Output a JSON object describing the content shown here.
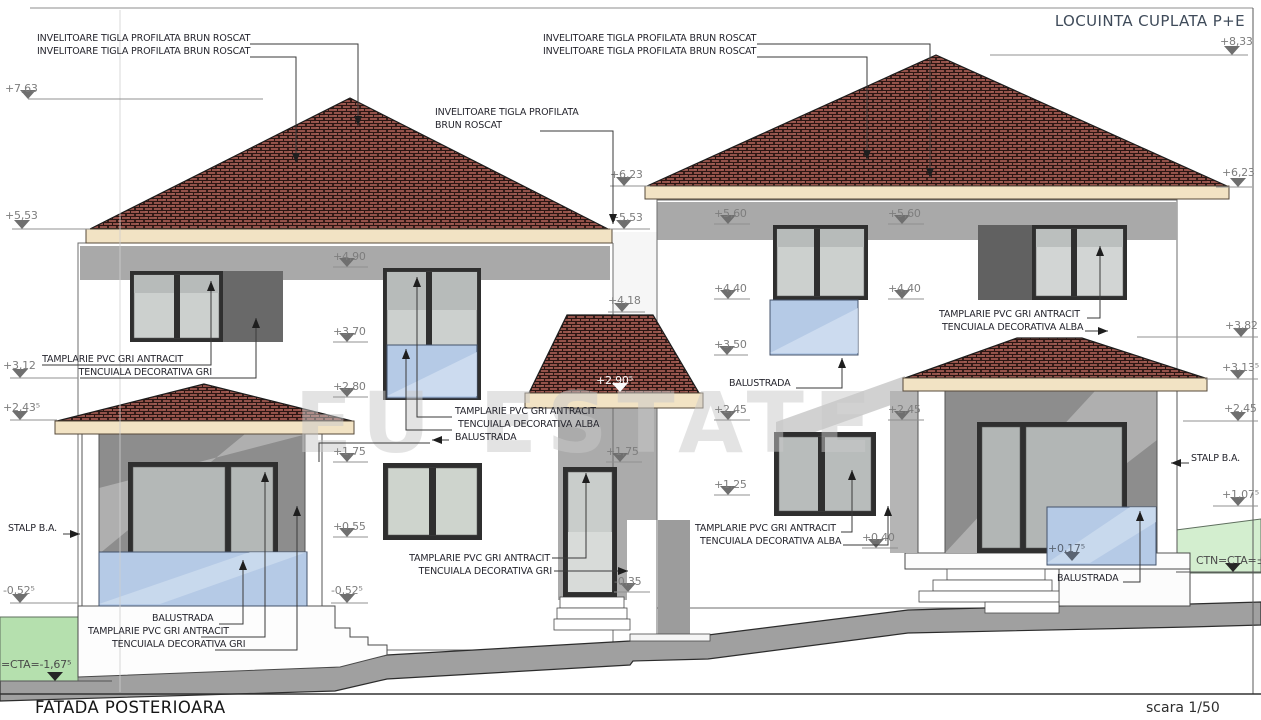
{
  "title": "LOCUINTA CUPLATA P+E",
  "footer": {
    "name": "FATADA POSTERIOARA",
    "scale": "scara 1/50"
  },
  "watermark": "EU ESTATE",
  "colors": {
    "roof_tile": "#94524a",
    "eave_band": "#f2e3c4",
    "balustrade_blue": "#b5cae6",
    "grass_left": "#b5e0ae",
    "grass_right": "#d3eecf",
    "terrain": "#a0a0a0",
    "porch_shadow": "#8d8d8d",
    "level_mark": "#7d7d7d"
  },
  "levels": [
    {
      "t": "+7,63",
      "x": 5,
      "y": 92,
      "tri": 28,
      "ly": 99,
      "l": [
        28,
        263
      ]
    },
    {
      "t": "+5,53",
      "x": 5,
      "y": 219,
      "tri": 22,
      "ly": 229,
      "l": [
        12,
        90
      ]
    },
    {
      "t": "+3,12",
      "x": 3,
      "y": 369,
      "tri": 20,
      "ly": 378,
      "l": [
        10,
        78
      ]
    },
    {
      "t": "+2,43⁵",
      "x": 3,
      "y": 411,
      "tri": 20,
      "ly": 420,
      "l": [
        10,
        57
      ]
    },
    {
      "t": "-0,52⁵",
      "x": 3,
      "y": 594,
      "tri": 20,
      "ly": 603,
      "l": [
        10,
        78
      ]
    },
    {
      "t": "=CTA=-1,67⁵",
      "x": 1,
      "y": 668,
      "tri": 55,
      "ly": 681,
      "l": [
        0,
        112
      ],
      "s": "dark"
    },
    {
      "t": "+4,90",
      "x": 333,
      "y": 260,
      "tri": 347,
      "ly": 267,
      "l": [
        333,
        368
      ]
    },
    {
      "t": "+3,70",
      "x": 333,
      "y": 335,
      "tri": 347,
      "ly": 342,
      "l": [
        333,
        368
      ]
    },
    {
      "t": "+2,80",
      "x": 333,
      "y": 390,
      "tri": 347,
      "ly": 397,
      "l": [
        333,
        368
      ]
    },
    {
      "t": "+1,75",
      "x": 333,
      "y": 455,
      "tri": 347,
      "ly": 462,
      "l": [
        333,
        368
      ]
    },
    {
      "t": "+0,55",
      "x": 333,
      "y": 530,
      "tri": 347,
      "ly": 537,
      "l": [
        333,
        368
      ]
    },
    {
      "t": "-0,52⁵",
      "x": 331,
      "y": 594,
      "tri": 347,
      "ly": 603,
      "l": [
        331,
        368
      ]
    },
    {
      "t": "+6,23",
      "x": 610,
      "y": 178,
      "tri": 624,
      "ly": 186,
      "l": [
        610,
        650
      ]
    },
    {
      "t": "+5,53",
      "x": 610,
      "y": 221,
      "tri": 624,
      "ly": 229,
      "l": [
        610,
        650
      ]
    },
    {
      "t": "+4,18",
      "x": 608,
      "y": 304,
      "tri": 622,
      "ly": 312,
      "l": [
        608,
        645
      ]
    },
    {
      "t": "+2,90⁵",
      "x": 596,
      "y": 384,
      "tri": 620,
      "ly": 392,
      "s": "white"
    },
    {
      "t": "+1,75",
      "x": 606,
      "y": 455,
      "tri": 620,
      "ly": 462,
      "l": [
        606,
        642
      ]
    },
    {
      "t": "-0,35",
      "x": 614,
      "y": 585,
      "tri": 628,
      "ly": 592,
      "l": [
        614,
        650
      ]
    },
    {
      "t": "+5,60",
      "x": 714,
      "y": 217,
      "tri": 728,
      "ly": 224,
      "l": [
        714,
        750
      ]
    },
    {
      "t": "+4,40",
      "x": 714,
      "y": 292,
      "tri": 728,
      "ly": 299,
      "l": [
        714,
        750
      ]
    },
    {
      "t": "+3,50",
      "x": 714,
      "y": 348,
      "tri": 727,
      "ly": 355,
      "l": [
        714,
        748
      ]
    },
    {
      "t": "+2,45",
      "x": 714,
      "y": 413,
      "tri": 728,
      "ly": 420,
      "l": [
        714,
        750
      ]
    },
    {
      "t": "+1,25",
      "x": 714,
      "y": 488,
      "tri": 728,
      "ly": 495,
      "l": [
        714,
        750
      ]
    },
    {
      "t": "+0,40",
      "x": 862,
      "y": 541,
      "tri": 876,
      "ly": 548,
      "l": [
        862,
        898
      ]
    },
    {
      "t": "+5,60",
      "x": 888,
      "y": 217,
      "tri": 902,
      "ly": 224,
      "l": [
        888,
        924
      ]
    },
    {
      "t": "+4,40",
      "x": 888,
      "y": 292,
      "tri": 902,
      "ly": 299,
      "l": [
        888,
        924
      ]
    },
    {
      "t": "+2,45",
      "x": 888,
      "y": 413,
      "tri": 902,
      "ly": 420,
      "l": [
        888,
        924
      ]
    },
    {
      "t": "+8,33",
      "x": 1220,
      "y": 45,
      "tri": 1232,
      "ly": 55,
      "l": [
        990,
        1248
      ]
    },
    {
      "t": "+6,23",
      "x": 1222,
      "y": 176,
      "tri": 1238,
      "ly": 187,
      "l": [
        1216,
        1252
      ]
    },
    {
      "t": "+3,82",
      "x": 1225,
      "y": 329,
      "tri": 1241,
      "ly": 337,
      "l": [
        1137,
        1258
      ]
    },
    {
      "t": "+3,13⁵",
      "x": 1222,
      "y": 371,
      "tri": 1238,
      "ly": 379,
      "l": [
        1205,
        1258
      ]
    },
    {
      "t": "+2,45",
      "x": 1224,
      "y": 412,
      "tri": 1238,
      "ly": 421,
      "l": [
        1183,
        1258
      ]
    },
    {
      "t": "+1,07⁵",
      "x": 1222,
      "y": 498,
      "tri": 1238,
      "ly": 506,
      "l": [
        1213,
        1258
      ]
    },
    {
      "t": "CTN=CTA=±",
      "x": 1196,
      "y": 564,
      "tri": 1233,
      "ly": 572,
      "l": [
        1176,
        1261
      ],
      "s": "dark"
    },
    {
      "t": "+0,17⁵",
      "x": 1048,
      "y": 552,
      "tri": 1072,
      "ly": 561,
      "s": "onblue"
    }
  ],
  "annotations": [
    {
      "n": "roof-label-top-left",
      "lines": [
        {
          "t": "INVELITOARE TIGLA PROFILATA BRUN ROSCAT",
          "x": 37,
          "y": 41
        },
        {
          "t": "INVELITOARE TIGLA PROFILATA BRUN ROSCAT",
          "x": 37,
          "y": 54
        }
      ],
      "leaders": [
        {
          "p": "250,44 358,44 358,126",
          "a": "down"
        },
        {
          "p": "250,57 296,57 296,163",
          "a": "down"
        }
      ]
    },
    {
      "n": "roof-label-top-mid",
      "lines": [
        {
          "t": "INVELITOARE TIGLA PROFILATA BRUN ROSCAT",
          "x": 543,
          "y": 41
        },
        {
          "t": "INVELITOARE TIGLA PROFILATA BRUN ROSCAT",
          "x": 543,
          "y": 54
        }
      ],
      "leaders": [
        {
          "p": "757,44 930,44 930,178",
          "a": "down"
        },
        {
          "p": "757,57 867,57 867,160",
          "a": "down"
        }
      ]
    },
    {
      "n": "roof-label-mid-left",
      "lines": [
        {
          "t": "INVELITOARE TIGLA PROFILATA",
          "x": 435,
          "y": 115
        },
        {
          "t": "BRUN ROSCAT",
          "x": 435,
          "y": 128
        }
      ],
      "leaders": [
        {
          "p": "540,131 613,131 613,224",
          "a": "down"
        }
      ]
    },
    {
      "n": "tamplarie-gri-upper-left",
      "lines": [
        {
          "t": "TAMPLARIE PVC GRI ANTRACIT",
          "x": 183,
          "y": 362,
          "a": "end"
        },
        {
          "t": "TENCUIALA DECORATIVA GRI",
          "x": 212,
          "y": 375,
          "a": "end"
        }
      ],
      "leaders": [
        {
          "p": "42,365 211,365 211,281",
          "a": "up"
        },
        {
          "p": "80,378 256,378 256,318",
          "a": "up"
        }
      ]
    },
    {
      "n": "tamplarie-alba-mid",
      "lines": [
        {
          "t": "TAMPLARIE PVC GRI ANTRACIT",
          "x": 455,
          "y": 414
        },
        {
          "t": "TENCUIALA DECORATIVA ALBA",
          "x": 458,
          "y": 427
        },
        {
          "t": "BALUSTRADA",
          "x": 455,
          "y": 440
        }
      ],
      "leaders": [
        {
          "p": "452,417 417,417 417,277",
          "a": "up"
        },
        {
          "p": "452,430 406,430 406,349",
          "a": "up"
        },
        {
          "p": "449,440 432,440",
          "a": "left"
        },
        {
          "p": "430,443 319,443 319,462",
          "a": "none"
        }
      ]
    },
    {
      "n": "stalp-ba-left",
      "lines": [
        {
          "t": "STALP B.A.",
          "x": 8,
          "y": 531
        }
      ],
      "leaders": [
        {
          "p": "63,534 80,534",
          "a": "right"
        }
      ]
    },
    {
      "n": "balustrada-bottom-left",
      "lines": [
        {
          "t": "BALUSTRADA",
          "x": 152,
          "y": 621
        }
      ],
      "leaders": [
        {
          "p": "219,624 243,624 243,560",
          "a": "up"
        }
      ]
    },
    {
      "n": "tamplarie-bottom-left",
      "lines": [
        {
          "t": "TAMPLARIE PVC GRI ANTRACIT",
          "x": 88,
          "y": 634
        }
      ],
      "leaders": [
        {
          "p": "201,637 265,637 265,472",
          "a": "up"
        }
      ]
    },
    {
      "n": "tencuiala-bottom-left",
      "lines": [
        {
          "t": "TENCUIALA DECORATIVA GRI",
          "x": 112,
          "y": 647
        }
      ],
      "leaders": [
        {
          "p": "215,650 297,650 297,506",
          "a": "up"
        }
      ]
    },
    {
      "n": "tamplarie-door-mid",
      "lines": [
        {
          "t": "TAMPLARIE PVC GRI ANTRACIT",
          "x": 550,
          "y": 561,
          "a": "end"
        },
        {
          "t": "TENCUIALA DECORATIVA GRI",
          "x": 552,
          "y": 574,
          "a": "end"
        }
      ],
      "leaders": [
        {
          "p": "552,558 586,558 586,473",
          "a": "up"
        },
        {
          "p": "554,571 628,571",
          "a": "right"
        }
      ]
    },
    {
      "n": "tamplarie-alba-right-upper",
      "lines": [
        {
          "t": "TAMPLARIE PVC GRI ANTRACIT",
          "x": 939,
          "y": 317
        },
        {
          "t": "TENCUIALA DECORATIVA ALBA",
          "x": 942,
          "y": 330
        }
      ],
      "leaders": [
        {
          "p": "1087,318 1100,318 1100,246",
          "a": "up"
        },
        {
          "p": "1085,331 1108,331",
          "a": "right"
        }
      ]
    },
    {
      "n": "balustrada-right-mid",
      "lines": [
        {
          "t": "BALUSTRADA",
          "x": 729,
          "y": 386
        }
      ],
      "leaders": [
        {
          "p": "796,388 842,388 842,358",
          "a": "up"
        }
      ]
    },
    {
      "n": "stalp-ba-right",
      "lines": [
        {
          "t": "STALP B.A.",
          "x": 1191,
          "y": 461
        }
      ],
      "leaders": [
        {
          "p": "1189,463 1171,463",
          "a": "left"
        }
      ]
    },
    {
      "n": "tamplarie-alba-bottom-right",
      "lines": [
        {
          "t": "TAMPLARIE PVC GRI ANTRACIT",
          "x": 695,
          "y": 531
        },
        {
          "t": "TENCUIALA DECORATIVA ALBA",
          "x": 700,
          "y": 544
        }
      ],
      "leaders": [
        {
          "p": "841,532 852,532 852,470",
          "a": "up"
        },
        {
          "p": "843,545 888,545 888,506",
          "a": "up"
        }
      ]
    },
    {
      "n": "balustrada-bottom-right",
      "lines": [
        {
          "t": "BALUSTRADA",
          "x": 1057,
          "y": 581
        }
      ],
      "leaders": [
        {
          "p": "1123,582 1140,582 1140,511",
          "a": "up"
        }
      ]
    }
  ]
}
